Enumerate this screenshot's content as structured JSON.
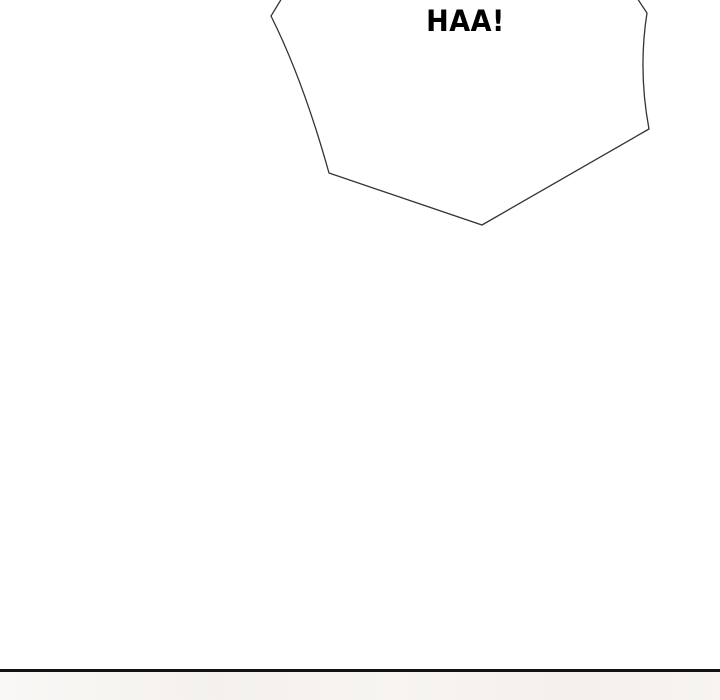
{
  "page": {
    "speech_bubble": {
      "text": "HAA!"
    },
    "colors": {
      "background": "#ffffff",
      "bubble_fill": "#ffffff",
      "bubble_outline": "#333333",
      "text": "#000000",
      "panel_divider": "#121212",
      "next_panel_background": "#f6f3f0"
    }
  }
}
